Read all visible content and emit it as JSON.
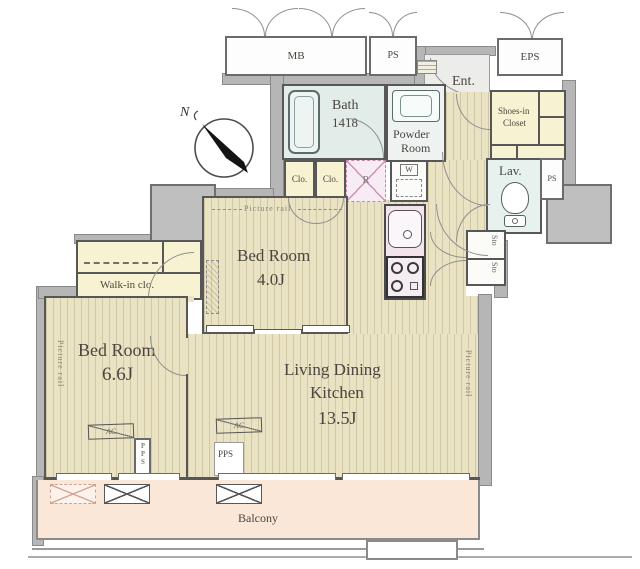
{
  "title": "1LDK+ apartment floor plan",
  "compass": {
    "north_label": "N"
  },
  "rooms": {
    "mb": "MB",
    "ps_top": "PS",
    "eps": "EPS",
    "ent": "Ent.",
    "bath_name": "Bath",
    "bath_size": "1418",
    "powder_line1": "Powder",
    "powder_line2": "Room",
    "shoes_line1": "Shoes-in",
    "shoes_line2": "Closet",
    "lav": "Lav.",
    "ps_side": "PS",
    "sto": "Sto",
    "clo": "Clo.",
    "fridge": "R",
    "washer": "W",
    "bed4_name": "Bed Room",
    "bed4_size": "4.0J",
    "walkin": "Walk-in clo.",
    "bed6_name": "Bed Room",
    "bed6_size": "6.6J",
    "ldk_line1": "Living Dining",
    "ldk_line2": "Kitchen",
    "ldk_size": "13.5J",
    "balcony": "Balcony"
  },
  "annotations": {
    "picture_rail": "Picture rail",
    "ac": "AC",
    "pps": "PPS"
  },
  "colors": {
    "floor_wood": "#e9e2c3",
    "closet_yellow": "#f7f3d2",
    "bath_blue": "#e2ece9",
    "kitchen_pink": "#f3e3ed",
    "balcony_peach": "#fbe7d7",
    "wall_gray": "#b6b6b6",
    "line_dark": "#575757"
  }
}
